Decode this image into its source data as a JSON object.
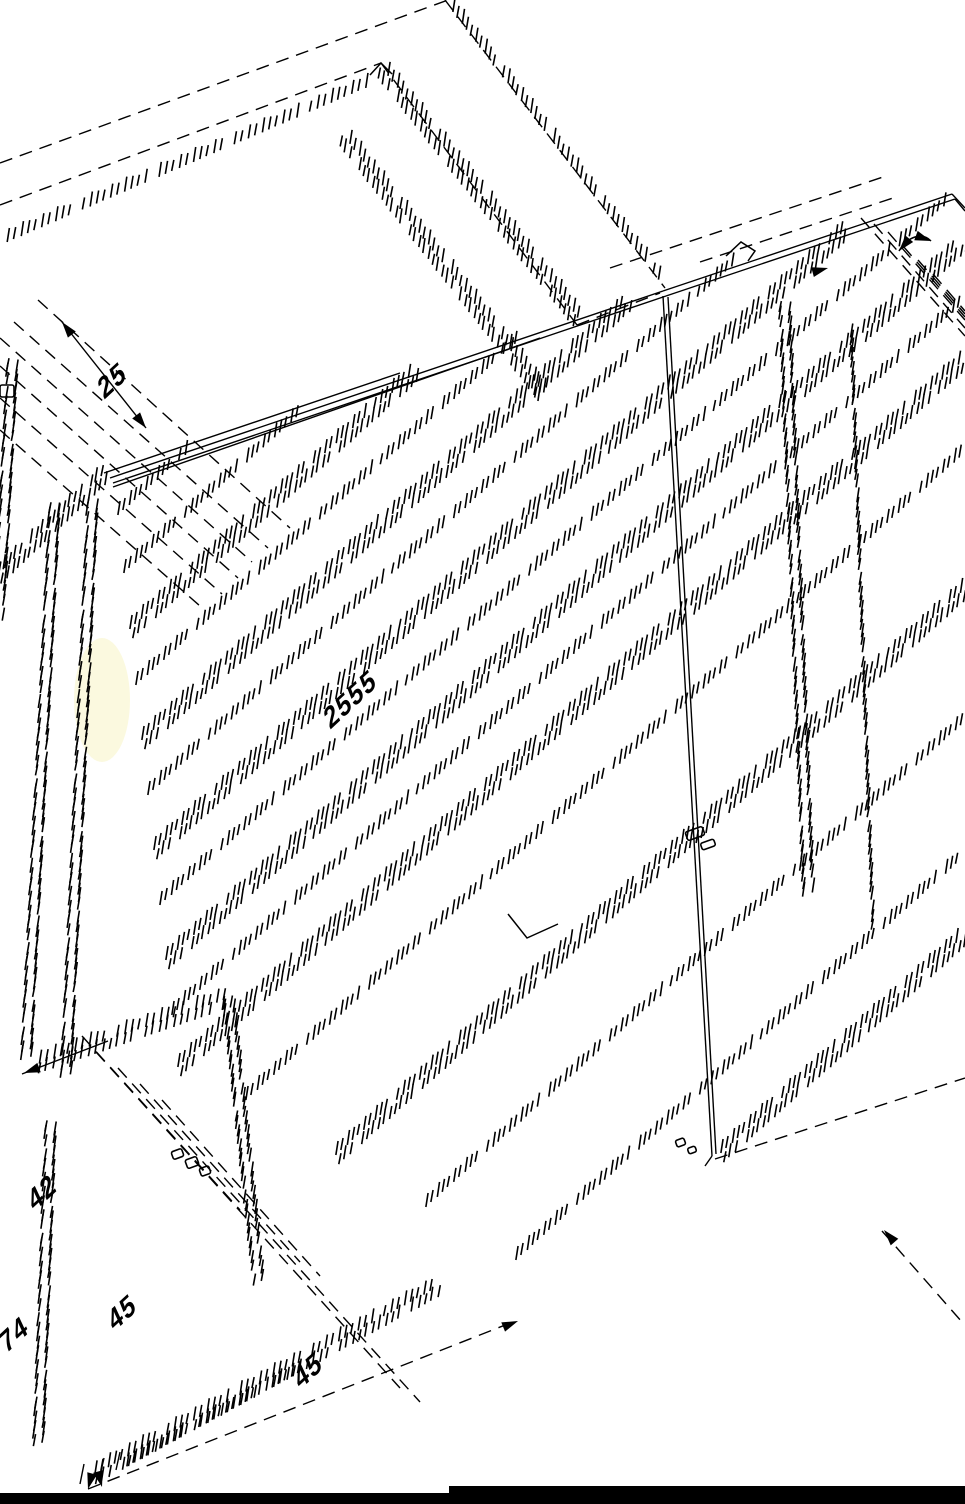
{
  "page": {
    "background": "#ffffff"
  },
  "drawing": {
    "description": "Rotated isometric CAD line drawing of a wardrobe cabinet with hatched board edges, dashed projection lines and dimension annotations",
    "line_color": "#000000",
    "highlight_color": "#f7f3c0",
    "bottom_bar_color": "#000000",
    "dimensions": [
      {
        "id": "top-left",
        "value": "25"
      },
      {
        "id": "center",
        "value": "2555"
      },
      {
        "id": "bottom-a",
        "value": "42"
      },
      {
        "id": "bottom-b",
        "value": "45"
      },
      {
        "id": "bottom-c",
        "value": "74"
      },
      {
        "id": "bottom-d",
        "value": "45"
      }
    ]
  }
}
